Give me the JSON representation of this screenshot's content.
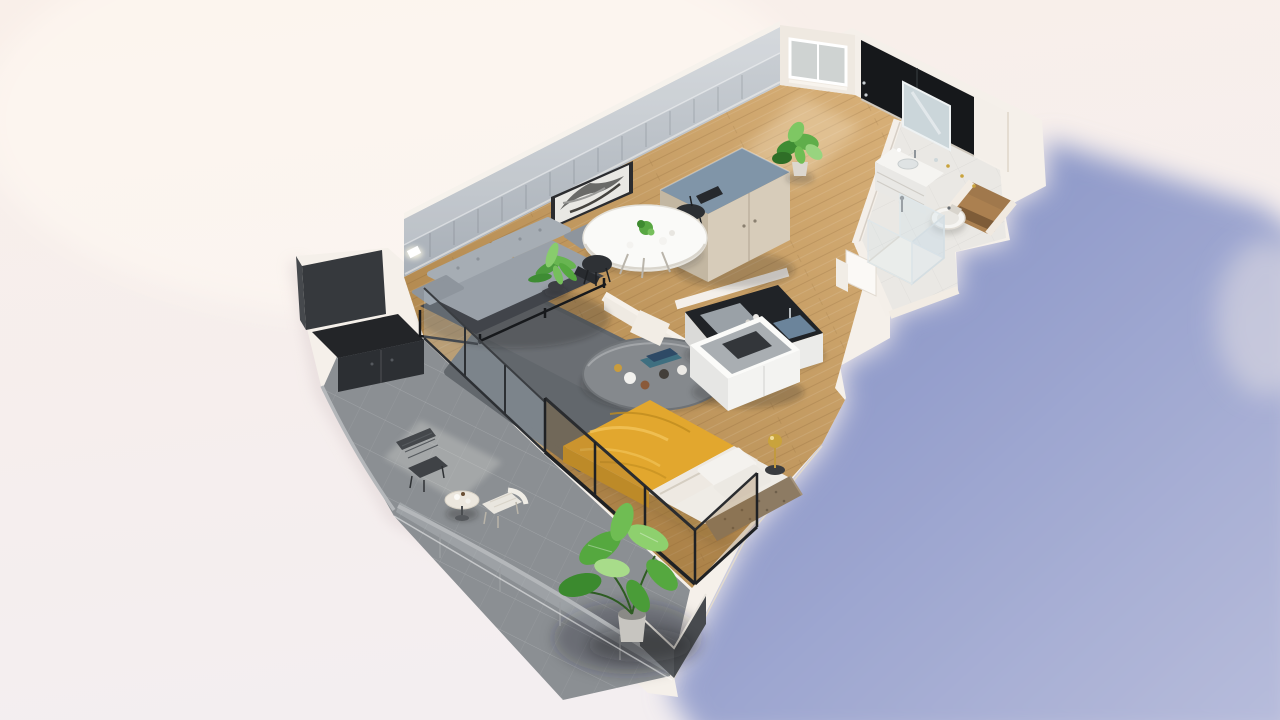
{
  "scene": {
    "title": "3D isometric cutaway floor plan render of a studio apartment with balcony",
    "type": "3d-floor-plan-render",
    "rooms": [
      "entry-hall",
      "dining-area",
      "living-room",
      "bedroom",
      "kitchenette",
      "bathroom",
      "storage-niche",
      "balcony"
    ],
    "furniture": [
      "entry-door",
      "wardrobe",
      "dining-table",
      "dining-chairs",
      "picture-frame",
      "sofa",
      "coffee-table",
      "area-rug",
      "bed",
      "pillows",
      "headboard",
      "bedside-lamp",
      "tv-stand",
      "kitchen-counter",
      "cooktop",
      "kitchen-sink",
      "vanity-with-mirror",
      "toilet",
      "shower-enclosure",
      "balcony-storage-unit",
      "balcony-table",
      "balcony-chairs",
      "glass-balustrade",
      "potted-plants"
    ],
    "colors": {
      "bg_top": "#f9efe9",
      "bg_bottom": "#f3eef0",
      "shadow_near": "#8e99c9",
      "shadow_far": "#b7bcdb",
      "slab": "#f5f0ea",
      "wall_white": "#f4efe9",
      "wall_panel_top": "#ccd1d6",
      "wall_panel_bottom": "#a9b0b8",
      "wood_light": "#d9b179",
      "wood_dark": "#b2894f",
      "tile": "#8b8f93",
      "bath_floor": "#eae8e4",
      "niche_wood": "#ab8050",
      "door_black": "#16181b",
      "rug": "#62676c",
      "sofa_cushion": "#a6adb4",
      "sofa_seat": "#99a0a8",
      "sofa_base": "#41444a",
      "table_gray": "#85898d",
      "dining_white": "#fafaf8",
      "wardrobe_top": "#8095a8",
      "wardrobe_front": "#d7ccba",
      "wardrobe_side": "#c3b7a2",
      "bed_yellow": "#e2a72e",
      "bed_yellow_deep": "#cf9826",
      "pillow_white": "#f4f2ee",
      "duvet_white": "#eee9e2",
      "headboard_brown": "#8d7b63",
      "kitchen_black": "#202327",
      "cooktop_gray": "#9aa1a7",
      "sink_blue": "#6b849b",
      "mirror_blue": "#cbd6da",
      "brass": "#c9a33c",
      "plant_dark": "#3b8a2e",
      "plant_mid": "#55a83f",
      "plant_light": "#8ed06e",
      "dark_unit": "#36393d",
      "balustrade_rail": "#b4b7ba",
      "balustrade_dark_panel": "#54575b",
      "glass_amber": "rgba(150,105,45,0.30)",
      "glass_clear": "rgba(205,220,230,0.25)"
    }
  }
}
